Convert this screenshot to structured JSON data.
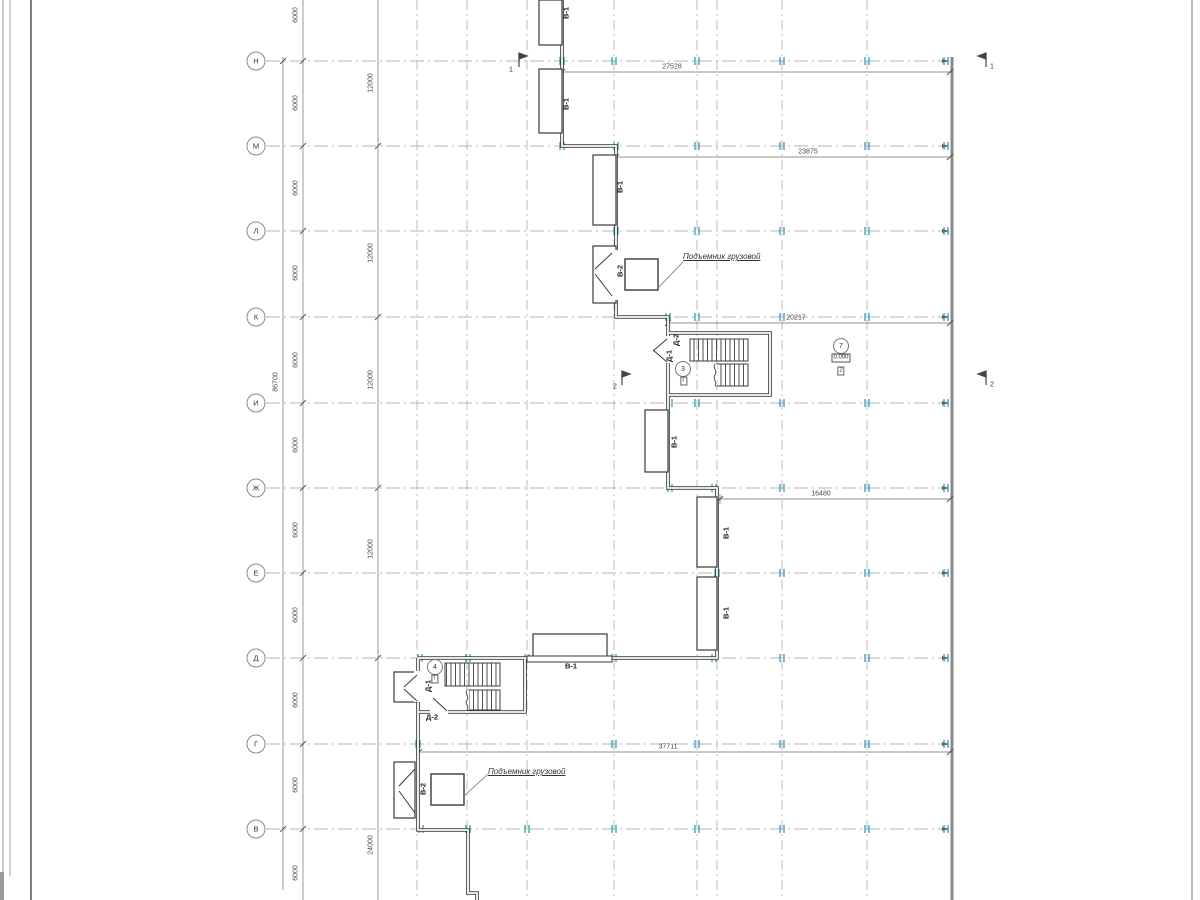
{
  "plan": {
    "colors": {
      "wall": "#3a3a3a",
      "grid": "#b5b5b5",
      "dim": "#6e6e6e",
      "tick": "#2f9fae",
      "text": "#333333",
      "matchline": "#8a8a8a"
    },
    "rows": [
      {
        "label": "Н",
        "y": 61
      },
      {
        "label": "М",
        "y": 146
      },
      {
        "label": "Л",
        "y": 231
      },
      {
        "label": "К",
        "y": 317
      },
      {
        "label": "И",
        "y": 403
      },
      {
        "label": "Ж",
        "y": 488
      },
      {
        "label": "Е",
        "y": 573
      },
      {
        "label": "Д",
        "y": 658
      },
      {
        "label": "Г",
        "y": 744
      },
      {
        "label": "В",
        "y": 829
      }
    ],
    "row_marker_x": 256,
    "row_line_x1": 266,
    "row_line_x2": 949,
    "grid_columns": [
      417,
      467,
      527,
      614,
      697,
      717,
      782,
      867
    ],
    "matchline": {
      "x": 952,
      "y1": 57,
      "y2": 900
    },
    "chains": [
      {
        "x": 283,
        "y1": 57,
        "y2": 890,
        "slash_ys": [
          61,
          829
        ]
      },
      {
        "x": 303,
        "y1": 0,
        "y2": 900,
        "slash_ys": [
          61,
          146,
          231,
          317,
          403,
          488,
          573,
          658,
          744,
          829
        ]
      },
      {
        "x": 378,
        "y1": 0,
        "y2": 900,
        "slash_ys": [
          146,
          317,
          488,
          658
        ]
      }
    ],
    "v_dim_labels": [
      {
        "t": "6000",
        "x": 296,
        "y": 15
      },
      {
        "t": "6000",
        "x": 296,
        "y": 103
      },
      {
        "t": "6000",
        "x": 296,
        "y": 188
      },
      {
        "t": "6000",
        "x": 296,
        "y": 273
      },
      {
        "t": "6000",
        "x": 296,
        "y": 360
      },
      {
        "t": "6000",
        "x": 296,
        "y": 445
      },
      {
        "t": "6000",
        "x": 296,
        "y": 530
      },
      {
        "t": "6000",
        "x": 296,
        "y": 615
      },
      {
        "t": "6000",
        "x": 296,
        "y": 700
      },
      {
        "t": "6000",
        "x": 296,
        "y": 785
      },
      {
        "t": "6000",
        "x": 296,
        "y": 873
      },
      {
        "t": "12000",
        "x": 371,
        "y": 83
      },
      {
        "t": "12000",
        "x": 371,
        "y": 253
      },
      {
        "t": "12000",
        "x": 371,
        "y": 380
      },
      {
        "t": "12000",
        "x": 371,
        "y": 549
      },
      {
        "t": "24000",
        "x": 371,
        "y": 845
      },
      {
        "t": "86700",
        "x": 276,
        "y": 382
      }
    ],
    "h_dims": [
      {
        "t": "27528",
        "y": 72,
        "x1": 562,
        "x2": 950,
        "tx": 672
      },
      {
        "t": "23875",
        "y": 157,
        "x1": 616,
        "x2": 950,
        "tx": 808
      },
      {
        "t": "20217",
        "y": 323,
        "x1": 668,
        "x2": 950,
        "tx": 796
      },
      {
        "t": "16480",
        "y": 499,
        "x1": 720,
        "x2": 950,
        "tx": 821
      },
      {
        "t": "37711",
        "y": 752,
        "x1": 419,
        "x2": 950,
        "tx": 668
      }
    ],
    "ticks": [
      {
        "y": 61,
        "xs": [
          562,
          614,
          697,
          782,
          867,
          946
        ]
      },
      {
        "y": 146,
        "xs": [
          562,
          616,
          697,
          782,
          867,
          946
        ]
      },
      {
        "y": 231,
        "xs": [
          616,
          697,
          782,
          867,
          946
        ]
      },
      {
        "y": 317,
        "xs": [
          668,
          697,
          782,
          867,
          946
        ]
      },
      {
        "y": 403,
        "xs": [
          670,
          697,
          782,
          867,
          946
        ]
      },
      {
        "y": 488,
        "xs": [
          670,
          714,
          782,
          867,
          946
        ]
      },
      {
        "y": 573,
        "xs": [
          717,
          782,
          867,
          946
        ]
      },
      {
        "y": 658,
        "xs": [
          420,
          468,
          527,
          614,
          714,
          782,
          867,
          946
        ]
      },
      {
        "y": 744,
        "xs": [
          418,
          614,
          697,
          782,
          867,
          946
        ]
      },
      {
        "y": 829,
        "xs": [
          421,
          468,
          527,
          614,
          697,
          782,
          867,
          946
        ]
      }
    ],
    "labels": {
      "win_rot": [
        {
          "t": "В-1",
          "x": 566,
          "y": 13
        },
        {
          "t": "В-1",
          "x": 566,
          "y": 104
        },
        {
          "t": "В-1",
          "x": 620,
          "y": 187
        },
        {
          "t": "В-1",
          "x": 674,
          "y": 442
        },
        {
          "t": "В-1",
          "x": 726,
          "y": 533
        },
        {
          "t": "В-1",
          "x": 726,
          "y": 613
        },
        {
          "t": "В-2",
          "x": 620,
          "y": 271
        },
        {
          "t": "В-2",
          "x": 423,
          "y": 789
        },
        {
          "t": "Д-2",
          "x": 676,
          "y": 340
        },
        {
          "t": "Д-1",
          "x": 669,
          "y": 356
        },
        {
          "t": "Д-1",
          "x": 428,
          "y": 686
        }
      ],
      "win_h": [
        {
          "t": "В-1",
          "x": 571,
          "y": 666
        },
        {
          "t": "Д-2",
          "x": 432,
          "y": 717
        }
      ],
      "lift": [
        {
          "t": "Подъемник грузовой",
          "x": 683,
          "y": 257
        },
        {
          "t": "Подъемник грузовой",
          "x": 488,
          "y": 772
        }
      ],
      "circles": [
        {
          "t": "3",
          "x": 683,
          "y": 369
        },
        {
          "t": "4",
          "x": 435,
          "y": 667
        },
        {
          "t": "7",
          "x": 841,
          "y": 346
        }
      ],
      "boxes": [
        {
          "t": "Г",
          "x": 684,
          "y": 381
        },
        {
          "t": "Г",
          "x": 435,
          "y": 679
        },
        {
          "t": "2",
          "x": 841,
          "y": 371
        }
      ],
      "elev": [
        {
          "t": "0.000",
          "x": 841,
          "y": 358
        }
      ],
      "sections": [
        {
          "t": "1",
          "x": 511,
          "y": 70
        },
        {
          "t": "1",
          "x": 992,
          "y": 67
        },
        {
          "t": "2",
          "x": 615,
          "y": 387
        },
        {
          "t": "2",
          "x": 992,
          "y": 385
        }
      ]
    }
  }
}
